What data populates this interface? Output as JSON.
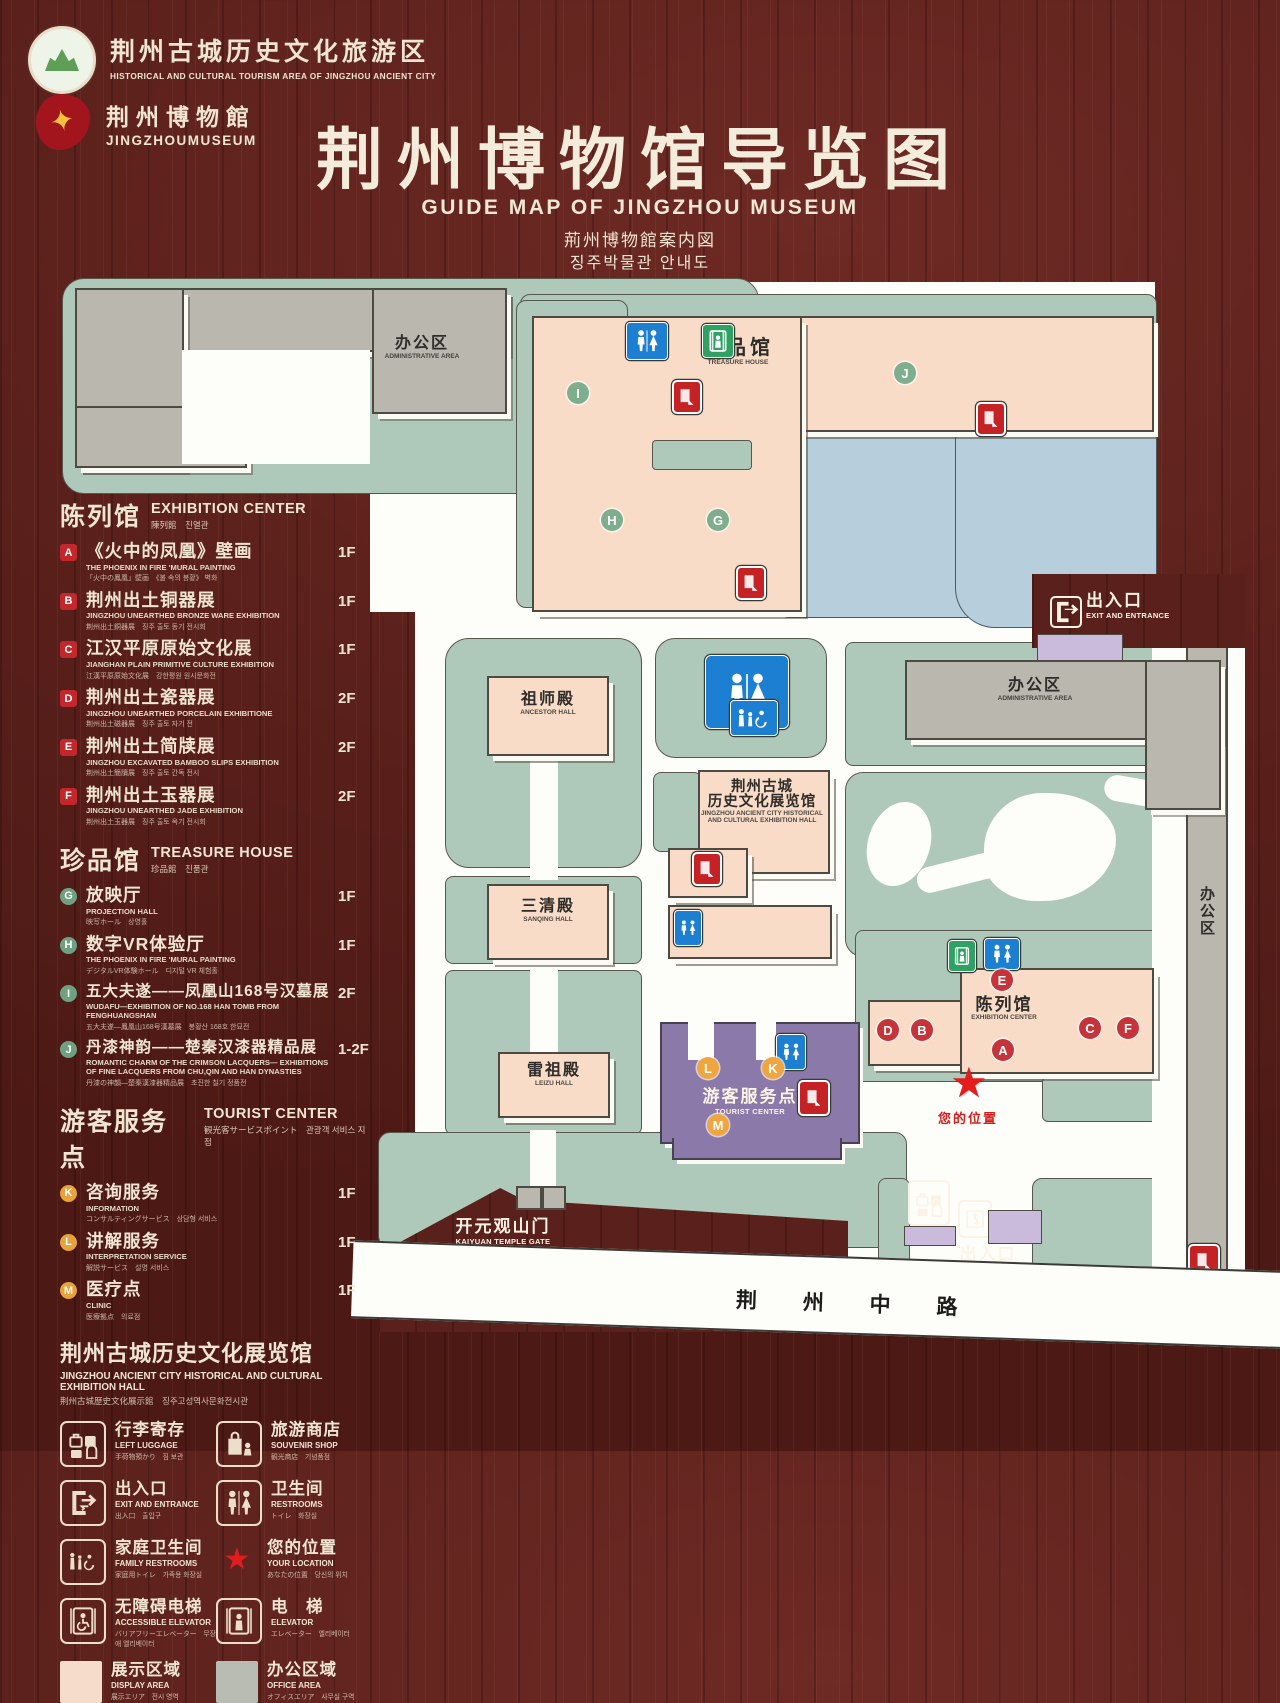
{
  "header": {
    "tourism_logo": {
      "zh": "荆州古城历史文化旅游区",
      "en": "HISTORICAL AND CULTURAL TOURISM AREA OF JINGZHOU ANCIENT CITY"
    },
    "museum_logo": {
      "zh": "荆州博物館",
      "en": "JINGZHOUMUSEUM"
    },
    "title": "荆州博物馆导览图",
    "subtitle_en": "GUIDE MAP OF JINGZHOU MUSEUM",
    "subtitle_ja": "荊州博物館案内図",
    "subtitle_ko": "징주박물관 안내도"
  },
  "legend": {
    "sections": [
      {
        "zh": "陈列馆",
        "en": "EXHIBITION CENTER",
        "sub": "陳列館　진열관",
        "items": [
          {
            "letter": "A",
            "zh": "《火中的凤凰》壁画",
            "en": "THE PHOENIX IN FIRE 'MURAL PAINTING",
            "sub": "「火中の鳳凰」壁画　《불 속의 봉황》 벽화",
            "floor": "1F"
          },
          {
            "letter": "B",
            "zh": "荆州出土铜器展",
            "en": "JINGZHOU UNEARTHED BRONZE WARE EXHIBITION",
            "sub": "荆州出土銅器展　징주 출토 동기 전시회",
            "floor": "1F"
          },
          {
            "letter": "C",
            "zh": "江汉平原原始文化展",
            "en": "JIANGHAN PLAIN PRIMITIVE CULTURE EXHIBITION",
            "sub": "江漢平原原始文化展　강한평원 원시문화전",
            "floor": "1F"
          },
          {
            "letter": "D",
            "zh": "荆州出土瓷器展",
            "en": "JINGZHOU UNEARTHED PORCELAIN EXHIBITIONE",
            "sub": "荆州出土磁器展　징주 출토 자기 전",
            "floor": "2F"
          },
          {
            "letter": "E",
            "zh": "荆州出土简牍展",
            "en": "JINGZHOU EXCAVATED BAMBOO SLIPS EXHIBITION",
            "sub": "荆州出土簡牘展　징주 출토 간독 전시",
            "floor": "2F"
          },
          {
            "letter": "F",
            "zh": "荆州出土玉器展",
            "en": "JINGZHOU UNEARTHED JADE EXHIBITION",
            "sub": "荆州出土玉器展　징주 출토 옥기 전시회",
            "floor": "2F"
          }
        ]
      },
      {
        "zh": "珍品馆",
        "en": "TREASURE HOUSE",
        "sub": "珍品館　진품관",
        "items": [
          {
            "letter": "G",
            "zh": "放映厅",
            "en": "PROJECTION HALL",
            "sub": "映写ホール　상영홀",
            "floor": "1F"
          },
          {
            "letter": "H",
            "zh": "数字VR体验厅",
            "en": "THE PHOENIX IN FIRE 'MURAL PAINTING",
            "sub": "デジタルVR体験ホール　디지털 VR 체험홀",
            "floor": "1F"
          },
          {
            "letter": "I",
            "zh": "五大夫遂——凤凰山168号汉墓展",
            "en": "WUDAFU—EXHIBITION OF NO.168 HAN TOMB FROM FENGHUANGSHAN",
            "sub": "五大夫遂—鳳凰山168号漢墓展　봉황산 168호 한묘전",
            "floor": "2F"
          },
          {
            "letter": "J",
            "zh": "丹漆神韵——楚秦汉漆器精品展",
            "en": "ROMANTIC CHARM OF THE CRIMSON LACQUERS— EXHIBITIONS OF FINE LACQUERS FROM CHU,QIN AND HAN DYNASTIES",
            "sub": "丹漆の神韻—楚秦漢漆器精品展　초진한 칠기 정품전",
            "floor": "1-2F"
          }
        ]
      },
      {
        "zh": "游客服务点",
        "en": "TOURIST CENTER",
        "sub": "観光客サービスポイント　관광객 서비스 지점",
        "items": [
          {
            "letter": "K",
            "zh": "咨询服务",
            "en": "INFORMATION",
            "sub": "コンサルティングサービス　상담형 서비스",
            "floor": "1F"
          },
          {
            "letter": "L",
            "zh": "讲解服务",
            "en": "INTERPRETATION SERVICE",
            "sub": "解説サービス　설명 서비스",
            "floor": "1F"
          },
          {
            "letter": "M",
            "zh": "医疗点",
            "en": "CLINIC",
            "sub": "医療拠点　의료점",
            "floor": "1F"
          }
        ]
      }
    ],
    "exhibition_hall_note": {
      "zh": "荆州古城历史文化展览馆",
      "en": "JINGZHOU ANCIENT CITY HISTORICAL AND CULTURAL EXHIBITION HALL",
      "sub": "荆州古城歴史文化展示館　징주고성역사문화전시관"
    },
    "facilities": [
      {
        "icon": "left-luggage-icon",
        "zh": "行李寄存",
        "en": "LEFT LUGGAGE",
        "sub": "手荷物預かり　짐 보관"
      },
      {
        "icon": "souvenir-shop-icon",
        "zh": "旅游商店",
        "en": "SOUVENIR SHOP",
        "sub": "観光商店　기념품점"
      },
      {
        "icon": "exit-entrance-icon",
        "zh": "出入口",
        "en": "EXIT AND ENTRANCE",
        "sub": "出入口　출입구"
      },
      {
        "icon": "restrooms-icon",
        "zh": "卫生间",
        "en": "RESTROOMS",
        "sub": "トイレ　화장실"
      },
      {
        "icon": "family-restrooms-icon",
        "zh": "家庭卫生间",
        "en": "FAMILY RESTROOMS",
        "sub": "家庭用トイレ　가족용 화장실"
      },
      {
        "icon": "your-location-icon",
        "zh": "您的位置",
        "en": "YOUR LOCATION",
        "sub": "あなたの位置　당신의 위치"
      },
      {
        "icon": "accessible-elevator-icon",
        "zh": "无障碍电梯",
        "en": "ACCESSIBLE ELEVATOR",
        "sub": "バリアフリーエレベーター　무장애 엘리베이터"
      },
      {
        "icon": "elevator-icon",
        "zh": "电　梯",
        "en": "ELEVATOR",
        "sub": "エレベーター　엘리베이터"
      },
      {
        "icon": "display-area-swatch",
        "zh": "展示区域",
        "en": "DISPLAY AREA",
        "sub": "展示エリア　전시 영역"
      },
      {
        "icon": "office-area-swatch",
        "zh": "办公区域",
        "en": "OFFICE AREA",
        "sub": "オフィスエリア　사무실 구역"
      }
    ]
  },
  "map": {
    "labels": {
      "admin_nw": {
        "zh": "办公区",
        "en": "ADMINISTRATIVE AREA"
      },
      "treasure_house": {
        "zh": "珍品馆",
        "en": "TREASURE HOUSE"
      },
      "exit_ne": {
        "zh": "出入口",
        "en": "EXIT AND ENTRANCE"
      },
      "admin_e": {
        "zh": "办公区",
        "en": "ADMINISTRATIVE AREA"
      },
      "admin_strip": {
        "zh": "办公区",
        "en": "ADMINISTRATIVE AREA"
      },
      "ancestor_hall": {
        "zh": "祖师殿",
        "en": "ANCESTOR HALL"
      },
      "history_hall": {
        "zh1": "荆州古城",
        "zh2": "历史文化展览馆",
        "en1": "JINGZHOU ANCIENT CITY HISTORICAL",
        "en2": "AND CULTURAL EXHIBITION HALL"
      },
      "sanqing_hall": {
        "zh": "三清殿",
        "en": "SANQING HALL"
      },
      "leizu_hall": {
        "zh": "雷祖殿",
        "en": "LEIZU HALL"
      },
      "tourist_center": {
        "zh": "游客服务点",
        "en": "TOURIST CENTER"
      },
      "exhibition_center": {
        "zh": "陈列馆",
        "en": "EXHIBITION CENTER"
      },
      "your_location": {
        "zh": "您的位置"
      },
      "kaiyuan_gate": {
        "zh": "开元观山门",
        "en": "KAIYUAN TEMPLE GATE"
      },
      "exit_s": {
        "zh": "出入口",
        "en": "EXIT AND ENTRANCE"
      },
      "road": {
        "zh": "荆 州 中 路"
      }
    },
    "badges": {
      "A": "A",
      "B": "B",
      "C": "C",
      "D": "D",
      "E": "E",
      "F": "F",
      "G": "G",
      "H": "H",
      "I": "I",
      "J": "J",
      "K": "K",
      "L": "L",
      "M": "M"
    }
  },
  "colors": {
    "wood": "#5a201b",
    "cream_text": "#efe5d1",
    "map_green": "#aec9b9",
    "building_pink": "#f8dcc8",
    "building_gray": "#b9b7ae",
    "lake_blue": "#b7cedd",
    "tourist_purple": "#8b79a9",
    "gate_lavender": "#cabbdc",
    "badge_red": "#c2272c",
    "badge_green": "#6fa181",
    "badge_yellow": "#e8a23c",
    "restroom_blue": "#1d7fd1",
    "elevator_green": "#2fa263",
    "facility_red": "#c42224",
    "location_red": "#e31c1c"
  }
}
